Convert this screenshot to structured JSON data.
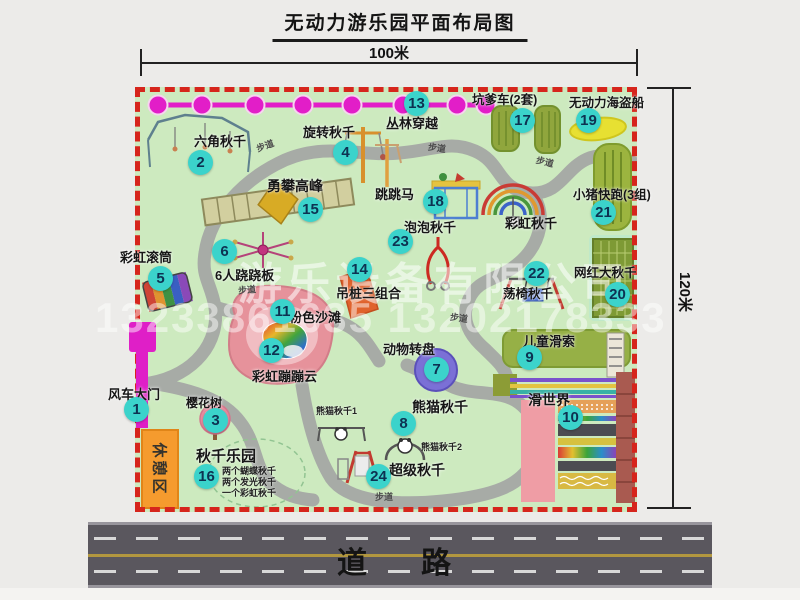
{
  "title": "无动力游乐园平面布局图",
  "dimensions": {
    "width_label": "100米",
    "height_label": "120米"
  },
  "road": {
    "label": "道　路"
  },
  "watermark": {
    "company": "游乐设备有限公司",
    "phone": "13233861635 13202178333"
  },
  "map": {
    "rest_area_label": "休憩区",
    "rainbow_swing_label": "彩虹秋千",
    "path_labels": [
      {
        "text": "步道",
        "x": 256,
        "y": 139,
        "rot": -20
      },
      {
        "text": "步道",
        "x": 428,
        "y": 141,
        "rot": 8
      },
      {
        "text": "步道",
        "x": 536,
        "y": 155,
        "rot": 14
      },
      {
        "text": "步道",
        "x": 238,
        "y": 283,
        "rot": -5
      },
      {
        "text": "步道",
        "x": 450,
        "y": 311,
        "rot": 8
      },
      {
        "text": "步道",
        "x": 375,
        "y": 490,
        "rot": 0
      }
    ],
    "items": [
      {
        "num": 1,
        "label": "风车大门",
        "bx": 124,
        "by": 397,
        "lx": 108,
        "ly": 384,
        "fs": 13
      },
      {
        "num": 2,
        "label": "六角秋千",
        "bx": 188,
        "by": 150,
        "lx": 194,
        "ly": 131,
        "fs": 13
      },
      {
        "num": 3,
        "label": "樱花树",
        "bx": 203,
        "by": 408,
        "lx": 186,
        "ly": 394,
        "fs": 12
      },
      {
        "num": 4,
        "label": "旋转秋千",
        "bx": 333,
        "by": 140,
        "lx": 303,
        "ly": 122,
        "fs": 13
      },
      {
        "num": 5,
        "label": "彩虹滚筒",
        "bx": 148,
        "by": 266,
        "lx": 120,
        "ly": 247,
        "fs": 13
      },
      {
        "num": 6,
        "label": "6人跷跷板",
        "bx": 212,
        "by": 239,
        "lx": 215,
        "ly": 265,
        "fs": 13
      },
      {
        "num": 7,
        "label": "动物转盘",
        "bx": 424,
        "by": 357,
        "lx": 383,
        "ly": 339,
        "fs": 13
      },
      {
        "num": 8,
        "label": "熊猫秋千",
        "bx": 391,
        "by": 411,
        "lx": 412,
        "ly": 397,
        "fs": 14,
        "subs": [
          {
            "text": "熊猫秋千1",
            "x": 316,
            "y": 404
          },
          {
            "text": "熊猫秋千2",
            "x": 421,
            "y": 440
          }
        ]
      },
      {
        "num": 9,
        "label": "儿童滑索",
        "bx": 517,
        "by": 345,
        "lx": 523,
        "ly": 331,
        "fs": 13
      },
      {
        "num": 10,
        "label": "滑世界",
        "bx": 558,
        "by": 405,
        "lx": 528,
        "ly": 390,
        "fs": 14
      },
      {
        "num": 11,
        "label": "粉色沙滩",
        "bx": 270,
        "by": 299,
        "lx": 289,
        "ly": 307,
        "fs": 13
      },
      {
        "num": 12,
        "label": "彩虹蹦蹦云",
        "bx": 259,
        "by": 338,
        "lx": 252,
        "ly": 366,
        "fs": 13
      },
      {
        "num": 13,
        "label": "丛林穿越",
        "bx": 404,
        "by": 91,
        "lx": 386,
        "ly": 113,
        "fs": 13
      },
      {
        "num": 14,
        "label": "吊桩三组合",
        "bx": 347,
        "by": 257,
        "lx": 336,
        "ly": 283,
        "fs": 13
      },
      {
        "num": 15,
        "label": "勇攀高峰",
        "bx": 298,
        "by": 197,
        "lx": 267,
        "ly": 176,
        "fs": 14
      },
      {
        "num": 16,
        "label": "秋千乐园",
        "bx": 194,
        "by": 464,
        "lx": 196,
        "ly": 445,
        "fs": 15,
        "subs": [
          {
            "text": "两个蝴蝶秋千",
            "x": 222,
            "y": 464
          },
          {
            "text": "两个发光秋千",
            "x": 222,
            "y": 475
          },
          {
            "text": "一个彩虹秋千",
            "x": 222,
            "y": 486
          }
        ]
      },
      {
        "num": 17,
        "label": "坑爹车(2套)",
        "bx": 510,
        "by": 108,
        "lx": 472,
        "ly": 89,
        "fs": 12.5
      },
      {
        "num": 18,
        "label": "跳跳马",
        "bx": 423,
        "by": 189,
        "lx": 375,
        "ly": 184,
        "fs": 13
      },
      {
        "num": 19,
        "label": "无动力海盗船",
        "bx": 576,
        "by": 108,
        "lx": 569,
        "ly": 92,
        "fs": 12.5
      },
      {
        "num": 20,
        "label": "网红大秋千",
        "bx": 605,
        "by": 282,
        "lx": 574,
        "ly": 262,
        "fs": 12.5
      },
      {
        "num": 21,
        "label": "小猪快跑(3组)",
        "bx": 591,
        "by": 200,
        "lx": 573,
        "ly": 184,
        "fs": 12.5
      },
      {
        "num": 22,
        "label": "荡椅秋千",
        "bx": 524,
        "by": 261,
        "lx": 503,
        "ly": 283,
        "fs": 12.5
      },
      {
        "num": 23,
        "label": "泡泡秋千",
        "bx": 388,
        "by": 229,
        "lx": 404,
        "ly": 217,
        "fs": 13
      },
      {
        "num": 24,
        "label": "超级秋千",
        "bx": 366,
        "by": 464,
        "lx": 389,
        "ly": 460,
        "fs": 14
      }
    ]
  },
  "colors": {
    "badge": "#3bd3cb",
    "border_dash": "#d6251c",
    "chain": "#e21ec8",
    "map_bg": "#cdeabf",
    "walkway": "#a7aba6",
    "road": "#5a575e"
  }
}
